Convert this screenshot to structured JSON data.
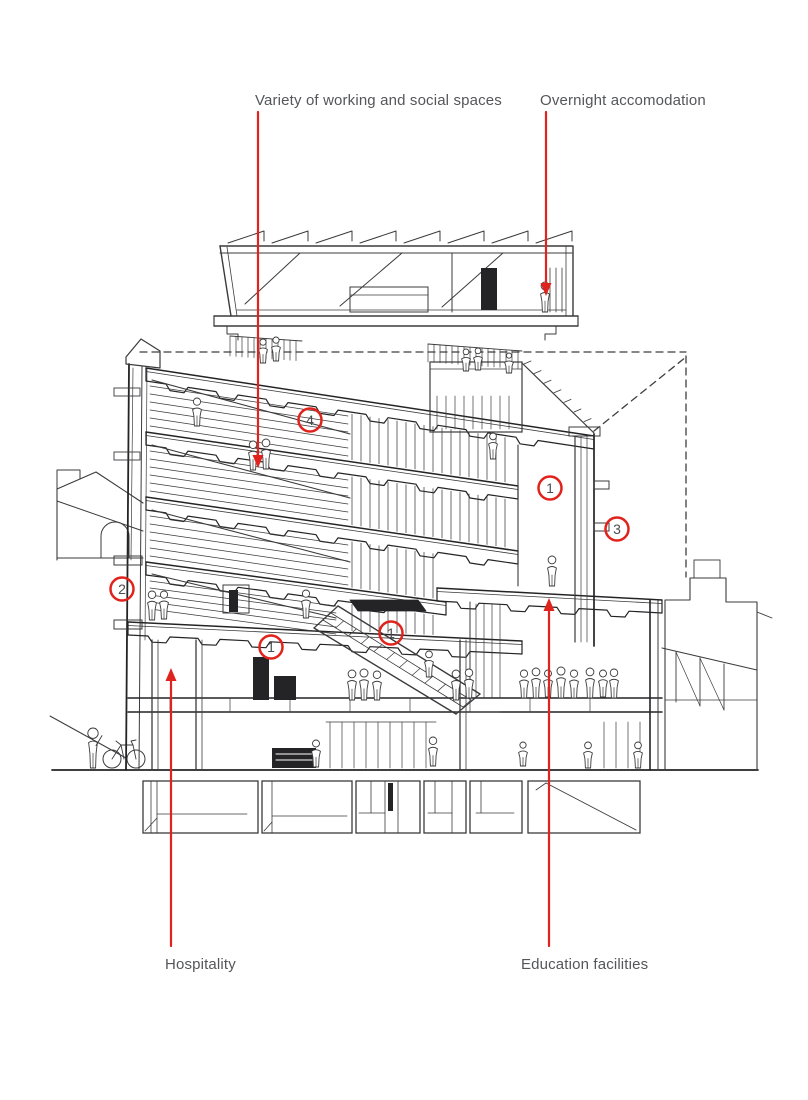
{
  "page": {
    "background": "#ffffff",
    "width": 808,
    "height": 1100
  },
  "annotations": {
    "labels": [
      {
        "id": "working-spaces-label",
        "text": "Variety of working and social spaces",
        "x": 255,
        "y": 92
      },
      {
        "id": "overnight-label",
        "text": "Overnight accomodation",
        "x": 540,
        "y": 92
      },
      {
        "id": "hospitality-label",
        "text": "Hospitality",
        "x": 165,
        "y": 956
      },
      {
        "id": "education-label",
        "text": "Education facilities",
        "x": 521,
        "y": 956
      }
    ],
    "arrows": [
      {
        "id": "working-spaces-arrow",
        "x": 258,
        "from_y": 112,
        "to_y": 468,
        "direction": "down"
      },
      {
        "id": "overnight-arrow",
        "x": 546,
        "from_y": 112,
        "to_y": 296,
        "direction": "down"
      },
      {
        "id": "hospitality-arrow",
        "x": 171,
        "from_y": 946,
        "to_y": 668,
        "direction": "up"
      },
      {
        "id": "education-arrow",
        "x": 549,
        "from_y": 946,
        "to_y": 598,
        "direction": "up"
      }
    ],
    "circled_numbers": [
      {
        "value": "4",
        "x": 310,
        "y": 420
      },
      {
        "value": "1",
        "x": 550,
        "y": 488
      },
      {
        "value": "3",
        "x": 617,
        "y": 529
      },
      {
        "value": "2",
        "x": 122,
        "y": 589
      },
      {
        "value": "1",
        "x": 391,
        "y": 633
      },
      {
        "value": "1",
        "x": 271,
        "y": 647
      }
    ],
    "colors": {
      "accent_red": "#e0231c",
      "label_text": "#55565a",
      "ink": "#3b3b3d",
      "digit_gray": "#4b4c4e"
    }
  }
}
